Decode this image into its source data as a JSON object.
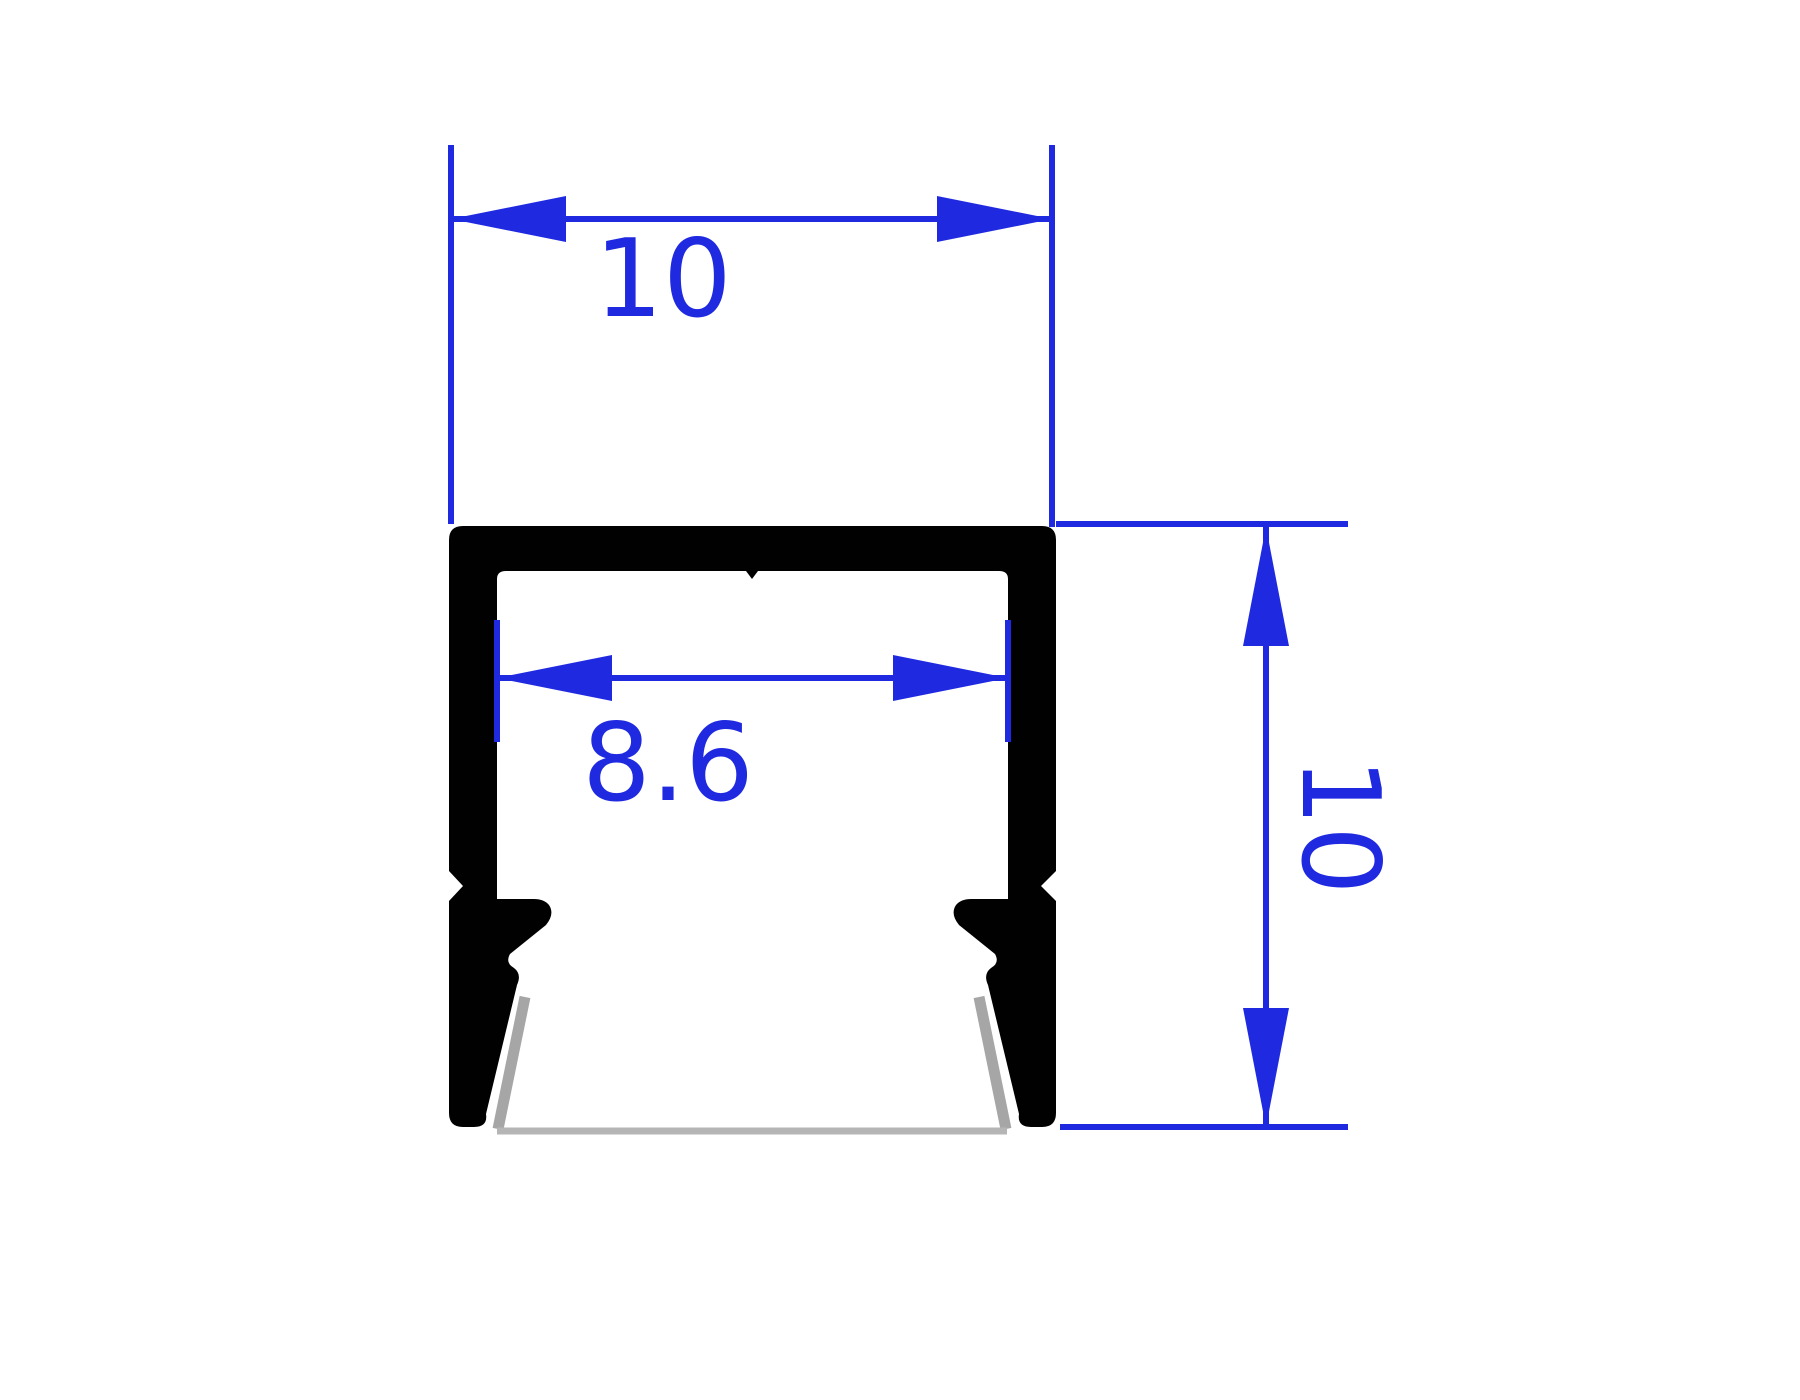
{
  "drawing": {
    "type": "technical-dimension-drawing",
    "subject": "aluminum-channel-profile-cross-section",
    "dimensions": {
      "outer_width": {
        "label": "10"
      },
      "inner_width": {
        "label": "8.6"
      },
      "outer_height": {
        "label": "10"
      }
    },
    "colors": {
      "dimension": "#1f2ae0",
      "profile": "#010101",
      "shadow": "#a6a6a6",
      "shadow_light": "#b5b5b5",
      "background": "#ffffff"
    }
  }
}
